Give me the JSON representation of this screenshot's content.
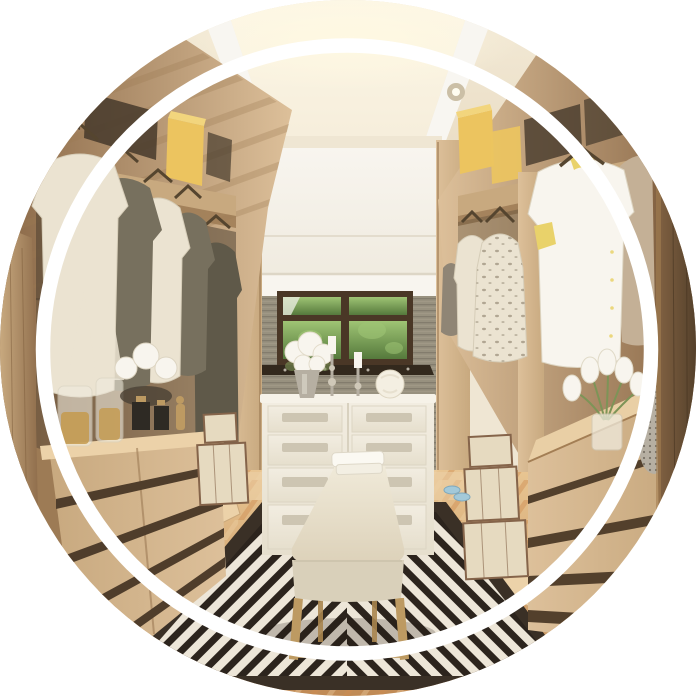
{
  "meta": {
    "alt": "Circular cropped photo of a luxury walk-in closet: light oak wardrobes with cream and olive shirts and a long coat hanging on the left, cream blouses, a floral dress and a yellow-trimmed white shirt on the right, yellow storage boxes on upper shelves, recessed ceiling spotlights, a white eight-drawer dresser topped with white hydrangeas, glass candlesticks and a glass ball below a garden window with a white roman shade, a cream upholstered bench with brass legs and folded towels on a black-and-white geometric striped rug over honey parquet flooring, stacked cream travel trunks, glass jars and white lotus flowers on the left counter, white tulips and a mosaic vase on the right wooden chest, all inside a thin white ring overlay."
  },
  "scene": {
    "type": "photograph",
    "crop": "circle",
    "subject": "walk-in closet interior",
    "ring": {
      "shape": "circle",
      "color": "#ffffff",
      "radius_px": 304,
      "thickness_px": 14
    },
    "objects": [
      "ceiling with recessed tray and cove light",
      "six recessed spotlights",
      "white roman shade",
      "garden window with green foliage",
      "gray textured wallpaper",
      "left wardrobe with hanging shirts and long coat",
      "yellow storage boxes",
      "right wardrobe with cream blouses and yellow-trim shirt",
      "white eight-drawer dresser",
      "white hydrangea bouquet in silver vase",
      "two glass candlesticks with white candles",
      "white glass ball ornament",
      "cream upholstered bench with brass legs",
      "folded white towels",
      "black and white geometric striped rug",
      "honey parquet floor",
      "left chest of drawers with glass jars and white lotus flowers",
      "right chest of drawers with white tulips and mosaic vase",
      "stacked cream travel trunks",
      "blue slippers"
    ]
  },
  "palette": {
    "page-bg": "#ffffff",
    "ring": "#ffffff",
    "ceiling-base": "#f3ead7",
    "ceiling-edge": "#e7d9bf",
    "ceiling-glow": "#fdf7e6",
    "glow": "#fff9e2",
    "tray-white": "#f8f6f1",
    "wood-light": "#ddc09a",
    "wood-mid": "#c8a97f",
    "wood-dark": "#9d7b55",
    "wood-deep": "#8a6847",
    "wall-cream": "#efe6d3",
    "shade-hi": "#f8f5ef",
    "shade-lo": "#eee9dc",
    "shade-shadow": "#ddd6c6",
    "wall-gray": "#98917f",
    "wall-gray-dark": "#7b7466",
    "wall-gray-light": "#a8a08c",
    "window-frame": "#4a3726",
    "foliage-light": "#9fc474",
    "foliage-dark": "#55793c",
    "sill-dark": "#33291d",
    "dresser-white": "#f2ede1",
    "dresser-lo": "#e6dfcd",
    "dresser-shadow": "#d8d1bf",
    "drawer-handle": "#cdc5b2",
    "bench-hi": "#f0ead9",
    "bench-lo": "#ddd2ba",
    "bench-front": "#d9d0ba",
    "gold-leg": "#bd9a62",
    "gold-dark": "#a9854f",
    "rug-dark": "#2c241d",
    "rug-light": "#ede6d8",
    "rug-border": "#3a3026",
    "floor-hi": "#e8c592",
    "floor-lo": "#c08a55",
    "floor-orange": "#cf8c4f",
    "floor-light": "#ecd2a9",
    "cloth-cream": "#ebe3d1",
    "cloth-olive": "#77705e",
    "cloth-olive-dark": "#5f5949",
    "cloth-tan": "#c4b096",
    "cloth-gray": "#8f8575",
    "accent-yellow": "#e9d26a",
    "box-yellow": "#ecc45f",
    "box-yellow-top": "#f2d57d",
    "trunk-face": "#e6dac0",
    "trunk-trim": "#85644a",
    "glass-amber": "#c49a4e",
    "glass-light": "#efeadd",
    "flower-white": "#f8f5ee",
    "stem-green": "#7d9457",
    "silver-vase": "#b6afa2",
    "vase-dot": "#6e675c",
    "black-accent": "#2e2a24",
    "shadow-dark": "#463a2c",
    "spot-rim": "#cbbfa6",
    "spot-core": "#fffdf0",
    "hanger": "#55452f",
    "slipper-blue": "#a3c9d9",
    "floral-mark": "#a29783"
  }
}
